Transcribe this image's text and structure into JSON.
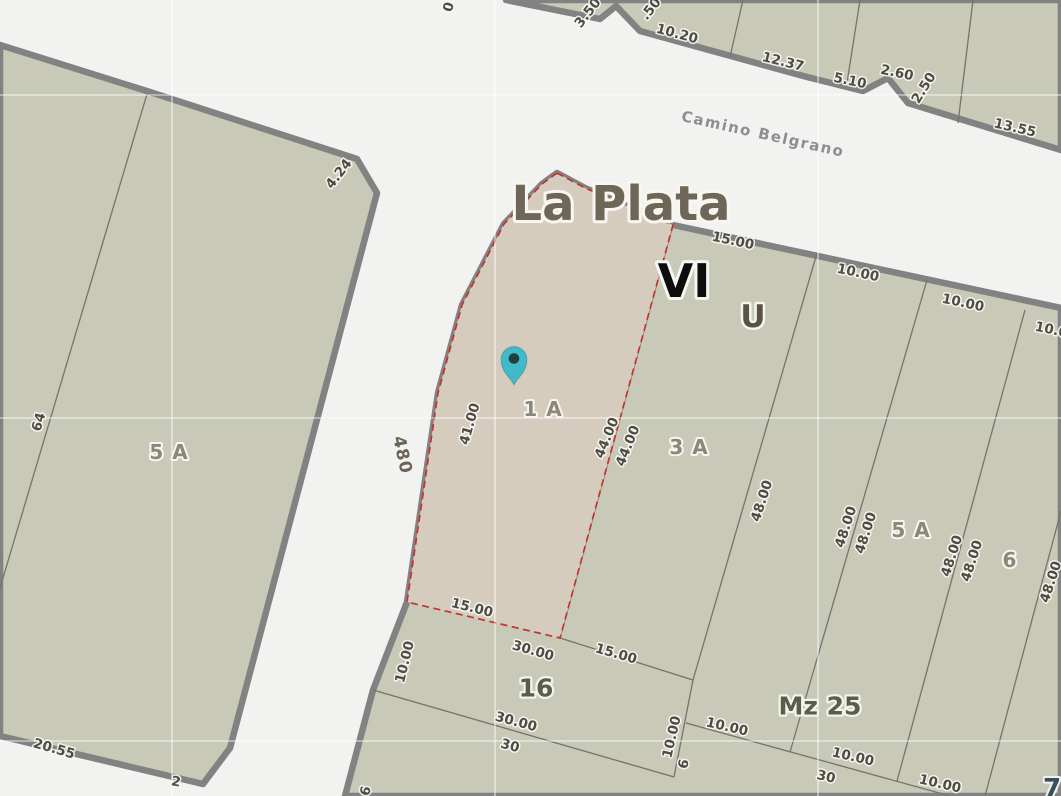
{
  "map": {
    "city": "La Plata",
    "street_name": "Camino Belgrano",
    "street_number": "480",
    "zone": "VI",
    "land_use": "U",
    "block": "Mz 25",
    "selected_parcel": "1 A"
  },
  "colors": {
    "road_background": "#f2f2f0",
    "parcel_fill": "#c8c9b7",
    "selected_parcel_fill": "#d6ccbe",
    "block_border": "#828282",
    "parcel_line": "#74746c",
    "selection_outline": "#c4332f",
    "pin_fill": "#41b9c8",
    "pin_dot": "#21403b"
  },
  "marker": {
    "name": "location-pin"
  },
  "labels": [
    {
      "t": "0",
      "x": 449,
      "y": 7,
      "r": -75,
      "c": "dim",
      "n": "dimension-label"
    },
    {
      "t": "3.50",
      "x": 588,
      "y": 13,
      "r": -52,
      "c": "dim",
      "n": "dimension-label"
    },
    {
      "t": ".50",
      "x": 651,
      "y": 9,
      "r": -52,
      "c": "dim",
      "n": "dimension-label"
    },
    {
      "t": "10.20",
      "x": 677,
      "y": 34,
      "r": 15,
      "c": "dim",
      "n": "dimension-label"
    },
    {
      "t": "12.37",
      "x": 783,
      "y": 62,
      "r": 14,
      "c": "dim",
      "n": "dimension-label"
    },
    {
      "t": "5.10",
      "x": 850,
      "y": 81,
      "r": 12,
      "c": "dim",
      "n": "dimension-label"
    },
    {
      "t": "2.60",
      "x": 897,
      "y": 73,
      "r": 12,
      "c": "dim",
      "n": "dimension-label"
    },
    {
      "t": "2.50",
      "x": 924,
      "y": 88,
      "r": -58,
      "c": "dim",
      "n": "dimension-label"
    },
    {
      "t": "13.55",
      "x": 1015,
      "y": 128,
      "r": 13,
      "c": "dim",
      "n": "dimension-label"
    },
    {
      "t": "4.24",
      "x": 339,
      "y": 174,
      "r": -52,
      "c": "dim",
      "n": "dimension-label"
    },
    {
      "t": "15.00",
      "x": 733,
      "y": 241,
      "r": 12,
      "c": "dim",
      "n": "dimension-label"
    },
    {
      "t": "10.00",
      "x": 858,
      "y": 273,
      "r": 12,
      "c": "dim",
      "n": "dimension-label"
    },
    {
      "t": "10.00",
      "x": 963,
      "y": 303,
      "r": 12,
      "c": "dim",
      "n": "dimension-label"
    },
    {
      "t": "10.00",
      "x": 1056,
      "y": 331,
      "r": 12,
      "c": "dim",
      "n": "dimension-label"
    },
    {
      "t": "41.00",
      "x": 470,
      "y": 424,
      "r": -74,
      "c": "dim",
      "n": "dimension-label"
    },
    {
      "t": "44.00",
      "x": 607,
      "y": 438,
      "r": -68,
      "c": "dim",
      "n": "dimension-label"
    },
    {
      "t": "44.00",
      "x": 628,
      "y": 446,
      "r": -68,
      "c": "dim",
      "n": "dimension-label"
    },
    {
      "t": "48.00",
      "x": 762,
      "y": 501,
      "r": -72,
      "c": "dim",
      "n": "dimension-label"
    },
    {
      "t": "48.00",
      "x": 846,
      "y": 527,
      "r": -72,
      "c": "dim",
      "n": "dimension-label"
    },
    {
      "t": "48.00",
      "x": 866,
      "y": 533,
      "r": -72,
      "c": "dim",
      "n": "dimension-label"
    },
    {
      "t": "48.00",
      "x": 952,
      "y": 556,
      "r": -72,
      "c": "dim",
      "n": "dimension-label"
    },
    {
      "t": "48.00",
      "x": 972,
      "y": 561,
      "r": -72,
      "c": "dim",
      "n": "dimension-label"
    },
    {
      "t": "48.00",
      "x": 1051,
      "y": 582,
      "r": -72,
      "c": "dim",
      "n": "dimension-label"
    },
    {
      "t": "64",
      "x": 39,
      "y": 422,
      "r": -74,
      "c": "dim",
      "n": "dimension-label"
    },
    {
      "t": "20.55",
      "x": 54,
      "y": 749,
      "r": 16,
      "c": "dim",
      "n": "dimension-label"
    },
    {
      "t": "2",
      "x": 176,
      "y": 782,
      "r": 10,
      "c": "dim",
      "n": "dimension-label"
    },
    {
      "t": "15.00",
      "x": 472,
      "y": 608,
      "r": 14,
      "c": "dim",
      "n": "dimension-label"
    },
    {
      "t": "30.00",
      "x": 533,
      "y": 651,
      "r": 16,
      "c": "dim",
      "n": "dimension-label"
    },
    {
      "t": "15.00",
      "x": 616,
      "y": 654,
      "r": 16,
      "c": "dim",
      "n": "dimension-label"
    },
    {
      "t": "10.00",
      "x": 405,
      "y": 662,
      "r": -76,
      "c": "dim",
      "n": "dimension-label"
    },
    {
      "t": "6",
      "x": 366,
      "y": 791,
      "r": -75,
      "c": "dim",
      "n": "dimension-label"
    },
    {
      "t": "30.00",
      "x": 516,
      "y": 722,
      "r": 15,
      "c": "dim",
      "n": "dimension-label"
    },
    {
      "t": "30",
      "x": 510,
      "y": 746,
      "r": 15,
      "c": "dim",
      "n": "dimension-label"
    },
    {
      "t": "10.00",
      "x": 727,
      "y": 727,
      "r": 13,
      "c": "dim",
      "n": "dimension-label"
    },
    {
      "t": "10.00",
      "x": 853,
      "y": 757,
      "r": 13,
      "c": "dim",
      "n": "dimension-label"
    },
    {
      "t": "30",
      "x": 826,
      "y": 777,
      "r": 13,
      "c": "dim",
      "n": "dimension-label"
    },
    {
      "t": "10.00",
      "x": 940,
      "y": 784,
      "r": 13,
      "c": "dim",
      "n": "dimension-label"
    },
    {
      "t": "10.00",
      "x": 672,
      "y": 737,
      "r": -77,
      "c": "dim",
      "n": "dimension-label"
    },
    {
      "t": "6",
      "x": 684,
      "y": 764,
      "r": -77,
      "c": "dim",
      "n": "dimension-label"
    },
    {
      "t": "5 A",
      "x": 169,
      "y": 452,
      "r": 0,
      "c": "pname",
      "n": "parcel-label-5a-left"
    },
    {
      "t": "1 A",
      "x": 543,
      "y": 409,
      "r": 0,
      "c": "pname",
      "n": "parcel-label-1a"
    },
    {
      "t": "3 A",
      "x": 689,
      "y": 447,
      "r": 0,
      "c": "pname",
      "n": "parcel-label-3a"
    },
    {
      "t": "5 A",
      "x": 911,
      "y": 530,
      "r": 0,
      "c": "pname",
      "n": "parcel-label-5a-right"
    },
    {
      "t": "6",
      "x": 1010,
      "y": 560,
      "r": 0,
      "c": "pname",
      "n": "parcel-label-6"
    },
    {
      "t": "16",
      "x": 536,
      "y": 688,
      "r": 0,
      "c": "bname",
      "n": "parcel-label-16"
    },
    {
      "t": "Mz 25",
      "x": 820,
      "y": 706,
      "r": 0,
      "c": "bname",
      "n": "block-label-mz25"
    },
    {
      "t": "La Plata",
      "x": 621,
      "y": 204,
      "r": 0,
      "c": "city",
      "n": "city-label"
    },
    {
      "t": "VI",
      "x": 684,
      "y": 281,
      "r": 0,
      "c": "vi",
      "n": "zone-label"
    },
    {
      "t": "U",
      "x": 753,
      "y": 317,
      "r": 0,
      "c": "u",
      "n": "landuse-label"
    },
    {
      "t": "Camino Belgrano",
      "x": 763,
      "y": 134,
      "r": 12.5,
      "c": "street",
      "n": "street-name-label"
    },
    {
      "t": "480",
      "x": 402,
      "y": 455,
      "r": 78,
      "c": "snum",
      "n": "street-number-label"
    },
    {
      "t": "7",
      "x": 1052,
      "y": 789,
      "r": 0,
      "c": "seven",
      "n": "district-label-partial"
    }
  ]
}
